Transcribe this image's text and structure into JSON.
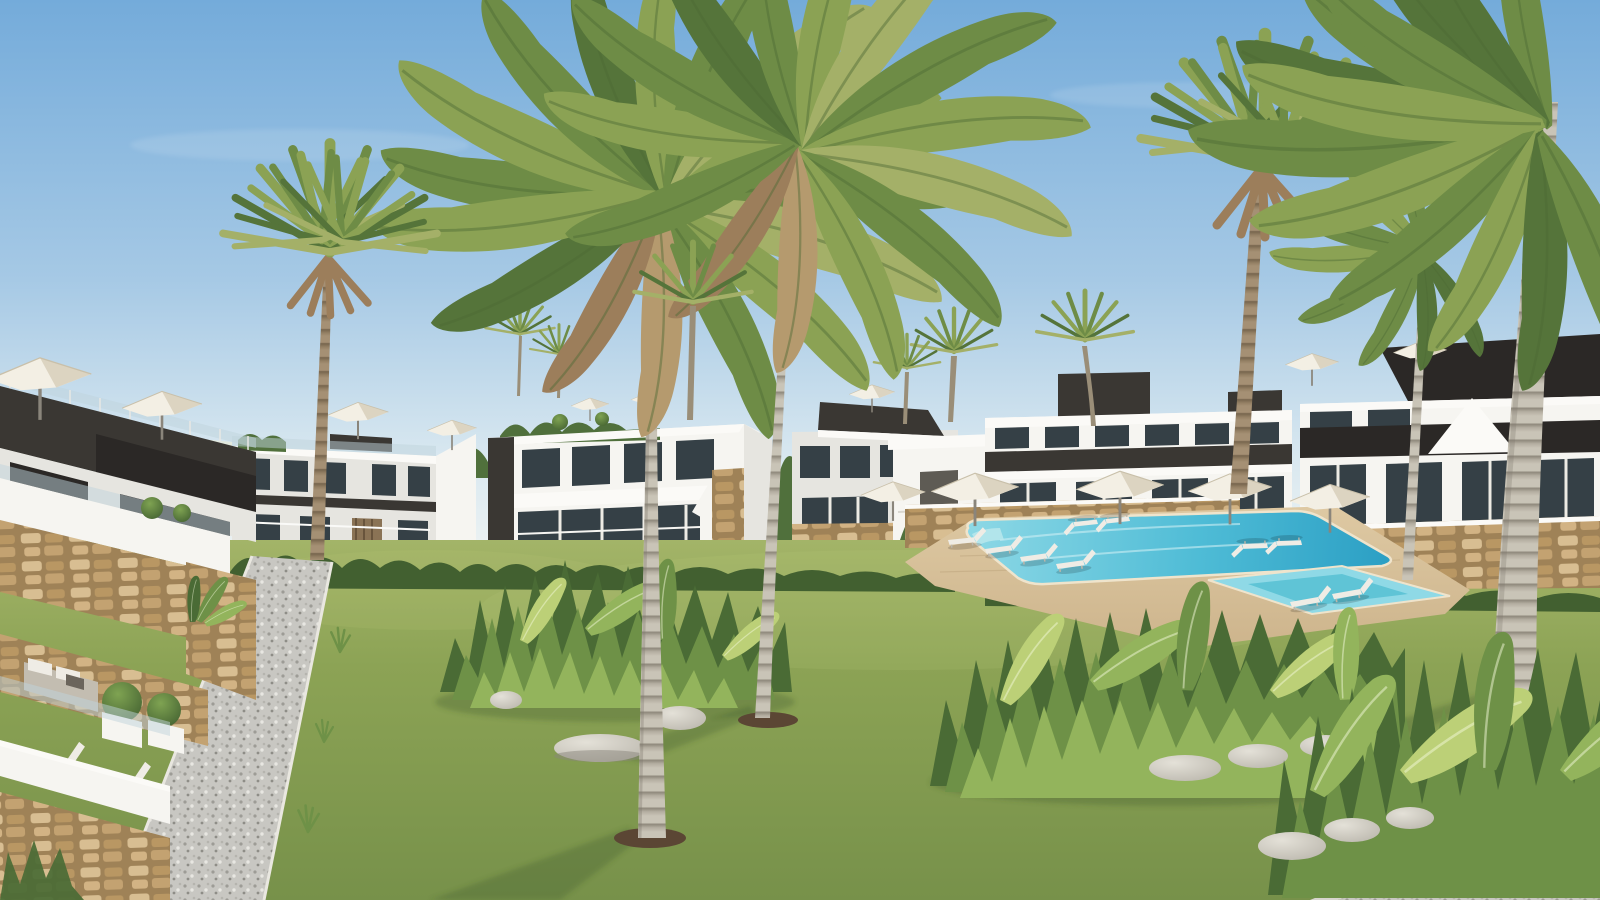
{
  "scene": {
    "type": "photorealistic-architectural-render",
    "description": "New-build residential complex: modern white and charcoal two-storey apartments around a landscaped garden with queen palms, fan palms, a turquoise communal swimming pool with kids pool, white sun loungers and parasols, stone retaining walls, glass balustrades, lawns, tropical plant beds with boulders and gravel paths under a clear blue sky.",
    "elements": [
      "sky",
      "background-treeline",
      "apartment-building-far-left",
      "apartment-building-center-a",
      "apartment-building-center-b",
      "pool-cabana",
      "apartment-building-right-c",
      "apartment-building-right-d",
      "roof-terrace-parasols",
      "glass-balustrades",
      "stone-retaining-walls",
      "lawn",
      "swimming-pool",
      "kids-pool",
      "pool-deck",
      "sun-loungers",
      "pool-parasols",
      "gravel-path",
      "gravel-border",
      "tropical-plant-bed-center",
      "tropical-plant-bed-right",
      "tropical-plant-bed-corner",
      "boulders",
      "queen-palm-left-main",
      "queen-palm-right-main",
      "fan-palm-left",
      "fan-palm-right",
      "queen-palm-edge-large",
      "queen-palm-edge-small",
      "background-fan-palms",
      "terrace-sofa",
      "terrace-loungers",
      "box-bushes",
      "planters"
    ],
    "counts": {
      "palms": 11,
      "parasols": 11,
      "pool_loungers": 10,
      "terrace_loungers": 2,
      "pools": 2,
      "boulders": 9
    }
  },
  "palette": {
    "sky_top": "#74ABDA",
    "sky_mid": "#A6C9E5",
    "sky_low": "#D9E8F0",
    "sky_horizon": "#EEF3F3",
    "grass_far": "#A3B468",
    "grass_mid": "#8CA355",
    "grass_near": "#77914A",
    "grass_sun": "#B9C77A",
    "pool_light": "#8FD9E6",
    "pool_mid": "#4FBCD6",
    "pool_deep": "#2B9FC4",
    "pool_kids": "#8FD9E6",
    "pool_rim": "#EFE4CC",
    "deck": "#CDB48C",
    "deck_light": "#DEC9A3",
    "stone_grout": "#9F8257",
    "stone_a": "#D8BE92",
    "stone_b": "#B99763",
    "stone_c": "#D2B384",
    "stone_d": "#C3A271",
    "wall_white": "#F6F5F1",
    "wall_shade": "#E6E5E0",
    "fascia": "#FBFAF7",
    "charcoal": "#3A3733",
    "charcoal_dark": "#2B2826",
    "wood_slat": "#8A7355",
    "window": "#354046",
    "glass_rail": "#BFD4DC",
    "trunk_light": "#C9C4B7",
    "trunk_band": "#8F897C",
    "trunk_brown": "#A59074",
    "trunk_brown_band": "#77654E",
    "frond_dark": "#55743A",
    "frond_mid": "#6E8C46",
    "frond_light": "#8BA254",
    "frond_pale": "#A4B068",
    "frond_dry": "#B59A6E",
    "frond_dead": "#9C7E5B",
    "leaf_dark": "#4A6B35",
    "leaf_mid": "#6E9147",
    "leaf_light": "#93B45C",
    "hedge": "#426030",
    "treeline": "#50703C",
    "rock_light": "#E4E1D8",
    "rock_shade": "#B4B0A6",
    "gravel": "#C8C7C2",
    "gravel_dark": "#9D9C96",
    "gravel_light": "#E8E7E2",
    "curb": "#D7D5CE",
    "parasol": "#F3EFE4",
    "parasol_shade": "#DCD4C1",
    "pole": "#8A857B",
    "furniture_white": "#EFECE5",
    "furniture_gray": "#C3BDB1",
    "dirt": "#5B4634",
    "lawn_shadow": "#3E5A2E"
  }
}
